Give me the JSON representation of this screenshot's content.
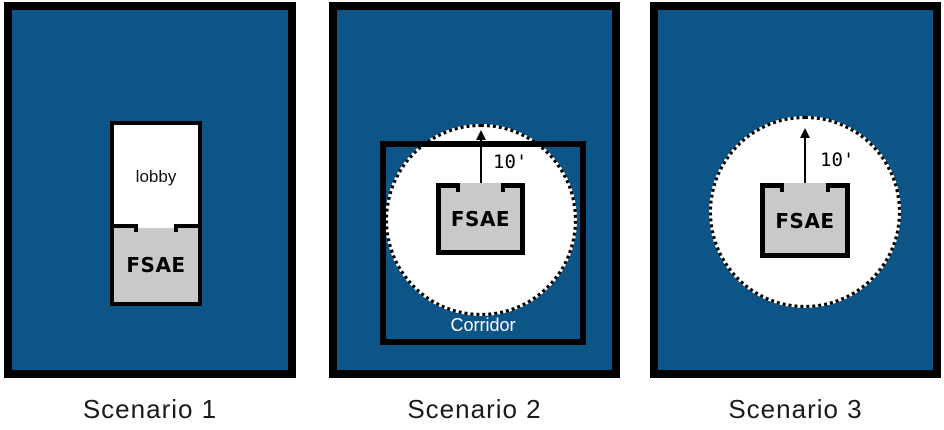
{
  "colors": {
    "plan_fill_blue": "#0E5587",
    "fsae_fill_gray": "#C9C9C9",
    "wall_black": "#000000",
    "open_space_white": "#FFFFFF",
    "corridor_text": "#FFFFFF",
    "caption_text": "#1A1A1A"
  },
  "scenarios": [
    {
      "caption": "Scenario 1",
      "labels": {
        "lobby": "lobby",
        "fsae": "FSAE"
      }
    },
    {
      "caption": "Scenario 2",
      "labels": {
        "fsae": "FSAE",
        "corridor": "Corridor",
        "distance": "10'"
      }
    },
    {
      "caption": "Scenario 3",
      "labels": {
        "fsae": "FSAE",
        "distance": "10'"
      }
    }
  ]
}
